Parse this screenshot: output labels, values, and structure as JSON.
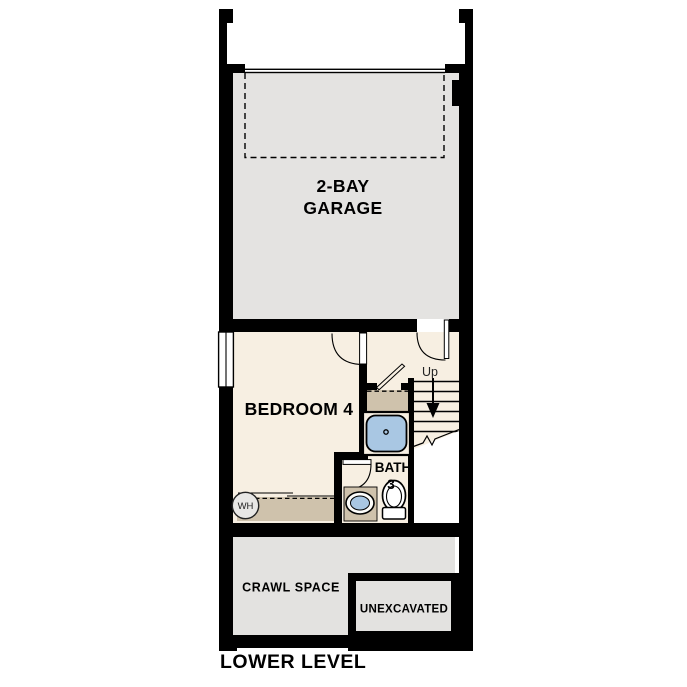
{
  "plan_title": "LOWER LEVEL",
  "rooms": {
    "garage": {
      "label_line1": "2-BAY",
      "label_line2": "GARAGE"
    },
    "bedroom4": {
      "label": "BEDROOM 4"
    },
    "bath3": {
      "label_line1": "BATH",
      "label_line2": "3"
    },
    "crawl_space": {
      "label": "CRAWL SPACE"
    },
    "unexcavated": {
      "label": "UNEXCAVATED"
    }
  },
  "annotations": {
    "stair_direction": "Up",
    "water_heater": "WH"
  },
  "colors": {
    "walls": "#000000",
    "garage_floor": "#e4e3e1",
    "living_floor": "#f7efe2",
    "crawl_floor": "#e3e2e0",
    "cabinet_tan": "#cfc2ac",
    "fixture_blue": "#a9c7e3",
    "fixture_white": "#fdfdfb",
    "background": "#ffffff"
  }
}
